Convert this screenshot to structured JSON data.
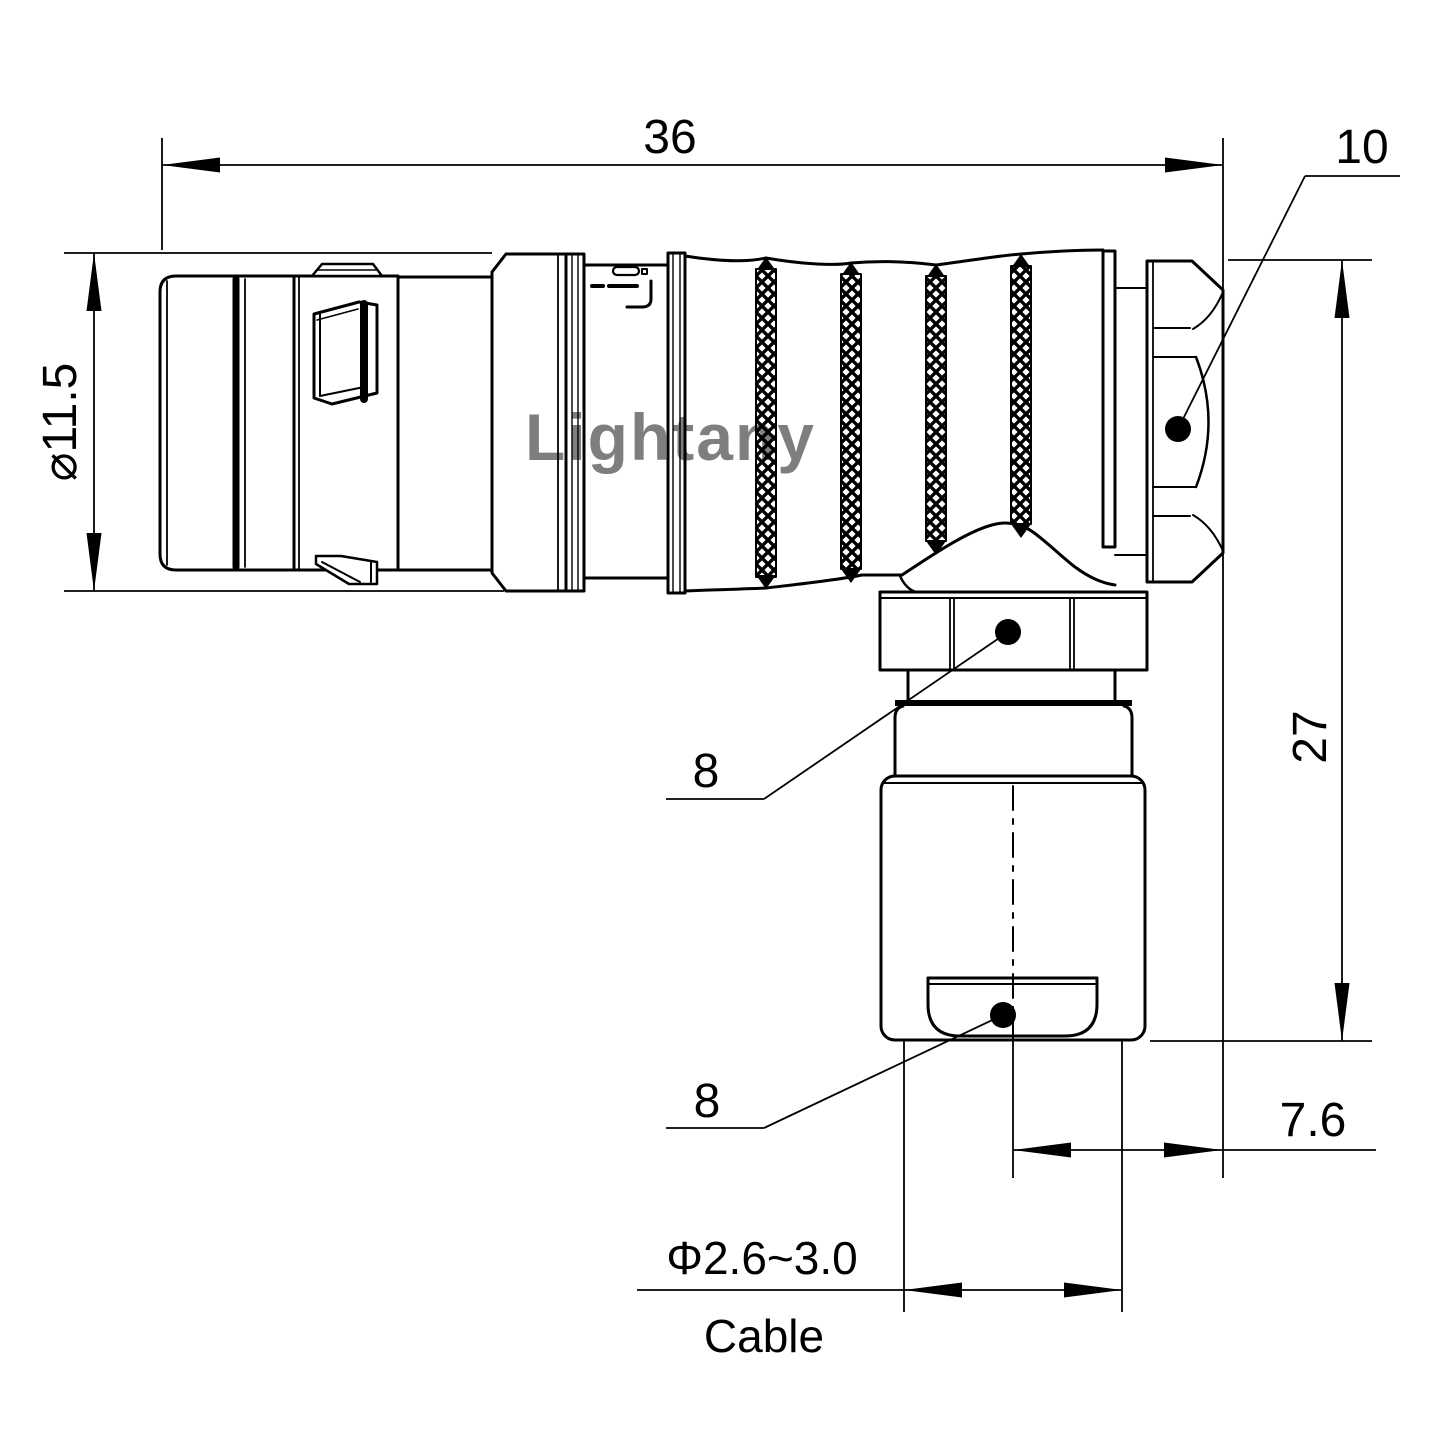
{
  "watermark": {
    "text": "Lightany",
    "color": "#e08f8f"
  },
  "dimensions": {
    "overall_length": "36",
    "rear_hex": "10",
    "front_diameter": "⌀11.5",
    "height": "27",
    "gland_hex": "8",
    "bushing_hex": "8",
    "rear_offset": "7.6",
    "cable_range": "Φ2.6~3.0",
    "cable_label": "Cable"
  },
  "colors": {
    "line": "#000000",
    "background": "#ffffff"
  }
}
